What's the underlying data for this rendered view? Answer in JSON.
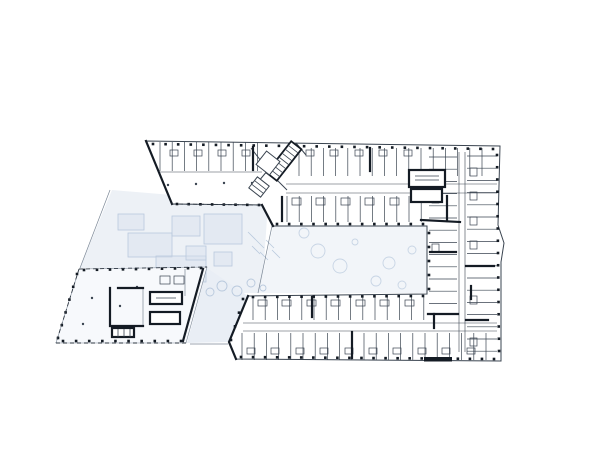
{
  "meta": {
    "drawing_type": "architectural-floor-plan",
    "canvas": {
      "width": 600,
      "height": 450
    }
  },
  "palette": {
    "white": "#ffffff",
    "ink": "#3a4450",
    "ink2": "#141b24",
    "thin": "#7c8897",
    "dash": "#2e3742",
    "wash": "#edf1f6",
    "wash2": "#e9eef5",
    "washCourt": "#f2f5f9",
    "pav": "#f7f9fc",
    "blue": "#b9c9dd",
    "blue2": "#d8e1ee"
  },
  "plan": {
    "washes": [
      {
        "name": "garden-wash",
        "points": "112,190 268,203 262,293 233,293 207,268 80,268",
        "fill": "wash"
      },
      {
        "name": "courtyard-wash",
        "points": "273,226 427,226 427,293 259,293",
        "fill": "washCourt"
      },
      {
        "name": "walkway-wash",
        "points": "207,268 248,296 229,342 187,343",
        "fill": "wash2"
      }
    ],
    "garden_rects": [
      [
        128,
        233,
        44,
        24
      ],
      [
        156,
        256,
        50,
        26
      ],
      [
        204,
        214,
        38,
        30
      ],
      [
        172,
        216,
        28,
        20
      ],
      [
        214,
        252,
        18,
        14
      ],
      [
        118,
        214,
        26,
        16
      ],
      [
        186,
        246,
        20,
        14
      ]
    ],
    "hatches": [
      [
        248,
        232,
        256,
        240
      ],
      [
        256,
        240,
        264,
        248
      ],
      [
        252,
        246,
        260,
        254
      ],
      [
        260,
        252,
        268,
        260
      ],
      [
        266,
        240,
        274,
        248
      ],
      [
        272,
        250,
        280,
        258
      ]
    ],
    "scribbles": [
      [
        222,
        286,
        5
      ],
      [
        237,
        291,
        5
      ],
      [
        251,
        283,
        4
      ],
      [
        263,
        288,
        3
      ],
      [
        210,
        292,
        4
      ]
    ],
    "trees": [
      [
        318,
        251,
        7
      ],
      [
        340,
        266,
        7
      ],
      [
        389,
        263,
        6
      ],
      [
        376,
        281,
        5
      ],
      [
        304,
        233,
        5
      ],
      [
        412,
        250,
        4
      ],
      [
        402,
        285,
        4
      ],
      [
        355,
        242,
        3
      ]
    ],
    "outline": "146,141 500,146 498,225 504,243 501,262 501,361 236,359 229,342 248,296 427,294 427,226 273,226 262,205 172,204",
    "pavilion": "79,269 207,267 186,343 56,343",
    "combs": [
      {
        "dir": "v",
        "o": 160,
        "s": 12.2,
        "n": 9,
        "a": 142,
        "b": 171
      },
      {
        "dir": "v",
        "o": 299,
        "s": 12.2,
        "n": 16,
        "a": 148,
        "b": 176
      },
      {
        "dir": "v",
        "o": 287,
        "s": 12.2,
        "n": 12,
        "a": 196,
        "b": 222
      },
      {
        "dir": "v",
        "o": 253,
        "s": 12.2,
        "n": 15,
        "a": 297,
        "b": 320
      },
      {
        "dir": "v",
        "o": 242,
        "s": 12.2,
        "n": 21,
        "a": 333,
        "b": 360
      },
      {
        "dir": "h",
        "o": 157,
        "s": 12.2,
        "n": 13,
        "a": 429,
        "b": 457
      },
      {
        "dir": "h",
        "o": 156,
        "s": 12.2,
        "n": 17,
        "a": 467,
        "b": 497
      }
    ],
    "corridors": [
      [
        286,
        184,
        497,
        184
      ],
      [
        286,
        193,
        497,
        193
      ],
      [
        243,
        323,
        497,
        323
      ],
      [
        243,
        331,
        497,
        331
      ],
      [
        459,
        152,
        459,
        352
      ],
      [
        465,
        152,
        465,
        352
      ],
      [
        160,
        172,
        262,
        172
      ]
    ],
    "thin_lines": [
      [
        143,
        288,
        143,
        326
      ],
      [
        185,
        269,
        185,
        296
      ],
      [
        272,
        226,
        258,
        293
      ],
      [
        190,
        344,
        228,
        344
      ],
      [
        110,
        190,
        80,
        268
      ]
    ],
    "diag_lines": [
      [
        251,
        148,
        268,
        170
      ],
      [
        268,
        170,
        258,
        182
      ],
      [
        296,
        143,
        306,
        155
      ],
      [
        277,
        180,
        287,
        190
      ]
    ],
    "pods": [
      [
        170,
        150,
        8,
        6
      ],
      [
        194,
        150,
        8,
        6
      ],
      [
        218,
        150,
        8,
        6
      ],
      [
        242,
        150,
        8,
        6
      ],
      [
        306,
        150,
        8,
        6
      ],
      [
        330,
        150,
        8,
        6
      ],
      [
        355,
        150,
        8,
        6
      ],
      [
        379,
        150,
        8,
        6
      ],
      [
        404,
        150,
        8,
        6
      ],
      [
        292,
        198,
        9,
        7
      ],
      [
        316,
        198,
        9,
        7
      ],
      [
        341,
        198,
        9,
        7
      ],
      [
        365,
        198,
        9,
        7
      ],
      [
        390,
        198,
        9,
        7
      ],
      [
        258,
        300,
        9,
        6
      ],
      [
        282,
        300,
        9,
        6
      ],
      [
        307,
        300,
        9,
        6
      ],
      [
        331,
        300,
        9,
        6
      ],
      [
        356,
        300,
        9,
        6
      ],
      [
        380,
        300,
        9,
        6
      ],
      [
        405,
        300,
        9,
        6
      ],
      [
        247,
        348,
        8,
        6
      ],
      [
        271,
        348,
        8,
        6
      ],
      [
        296,
        348,
        8,
        6
      ],
      [
        320,
        348,
        8,
        6
      ],
      [
        345,
        348,
        8,
        6
      ],
      [
        369,
        348,
        8,
        6
      ],
      [
        393,
        348,
        8,
        6
      ],
      [
        418,
        348,
        8,
        6
      ],
      [
        442,
        348,
        8,
        6
      ],
      [
        467,
        348,
        8,
        6
      ],
      [
        470,
        168,
        7,
        8
      ],
      [
        470,
        192,
        7,
        8
      ],
      [
        470,
        217,
        7,
        8
      ],
      [
        470,
        241,
        7,
        8
      ],
      [
        470,
        296,
        7,
        8
      ],
      [
        470,
        338,
        7,
        8
      ],
      [
        432,
        170,
        7,
        8
      ],
      [
        432,
        195,
        7,
        8
      ],
      [
        432,
        244,
        7,
        8
      ],
      [
        160,
        276,
        10,
        8
      ],
      [
        174,
        276,
        10,
        8
      ]
    ],
    "column_runs": [
      {
        "x1": 153,
        "y1": 144,
        "x2": 493,
        "y2": 149,
        "n": 28
      },
      {
        "x1": 177,
        "y1": 204,
        "x2": 259,
        "y2": 205,
        "n": 8
      },
      {
        "x1": 277,
        "y1": 224,
        "x2": 423,
        "y2": 224,
        "n": 13
      },
      {
        "x1": 253,
        "y1": 297,
        "x2": 423,
        "y2": 296,
        "n": 15
      },
      {
        "x1": 241,
        "y1": 357,
        "x2": 494,
        "y2": 359,
        "n": 22
      },
      {
        "x1": 497,
        "y1": 155,
        "x2": 499,
        "y2": 351,
        "n": 17
      },
      {
        "x1": 429,
        "y1": 233,
        "x2": 429,
        "y2": 289,
        "n": 5
      },
      {
        "x1": 84,
        "y1": 270,
        "x2": 201,
        "y2": 268,
        "n": 10
      },
      {
        "x1": 77,
        "y1": 274,
        "x2": 58,
        "y2": 338,
        "n": 6
      },
      {
        "x1": 63,
        "y1": 341,
        "x2": 181,
        "y2": 341,
        "n": 10
      },
      {
        "x1": 243,
        "y1": 299,
        "x2": 231,
        "y2": 340,
        "n": 4
      }
    ],
    "dots": [
      [
        168,
        185
      ],
      [
        196,
        184
      ],
      [
        224,
        183
      ],
      [
        252,
        183
      ],
      [
        92,
        298
      ],
      [
        83,
        324
      ],
      [
        137,
        287
      ],
      [
        120,
        306
      ]
    ],
    "bold_segments": [
      "146,141 172,204",
      "203,269 183,341",
      "248,296 229,342 236,359",
      "262,205 273,226",
      "421,220 460,222",
      "370,148 370,171",
      "253,147 253,170",
      "447,196 447,221",
      "430,252 456,252",
      "466,266 494,266",
      "428,314 458,314",
      "434,314 434,328",
      "466,320 488,320",
      "312,297 312,317",
      "352,332 352,358",
      "282,197 282,221",
      "110,288 110,326 143,326",
      "118,288 143,288",
      "471,286 471,299"
    ],
    "bars": [
      [
        424,
        357,
        28,
        4.5
      ]
    ],
    "cores": [
      {
        "x": 409,
        "y": 170,
        "w": 36,
        "h": 17,
        "inner": [
          [
            415,
            176,
            439,
            176
          ],
          [
            415,
            180,
            439,
            180
          ]
        ]
      },
      {
        "x": 411,
        "y": 189,
        "w": 31,
        "h": 13,
        "inner": []
      },
      {
        "x": 150,
        "y": 292,
        "w": 32,
        "h": 12,
        "inner": [
          [
            156,
            298,
            176,
            298
          ]
        ]
      },
      {
        "x": 150,
        "y": 312,
        "w": 30,
        "h": 12,
        "inner": []
      },
      {
        "x": 112,
        "y": 328,
        "w": 22,
        "h": 9,
        "inner": [
          [
            118,
            329,
            118,
            337
          ],
          [
            124,
            329,
            124,
            337
          ],
          [
            130,
            329,
            130,
            337
          ]
        ]
      }
    ],
    "stairs": [
      {
        "name": "main-stair",
        "cx": 284,
        "cy": 161,
        "w": 13,
        "h": 40,
        "angle": 38,
        "rungs": 7,
        "bold": true
      },
      {
        "name": "stair-landing",
        "cx": 268,
        "cy": 163,
        "w": 17,
        "h": 17,
        "angle": 38,
        "rungs": 0,
        "bold": false
      },
      {
        "name": "angled-room",
        "cx": 259,
        "cy": 187,
        "w": 15,
        "h": 14,
        "angle": 38,
        "rungs": 2,
        "bold": false
      }
    ],
    "dashed_edges": [
      [
        172,
        204,
        262,
        205
      ],
      [
        79,
        269,
        207,
        267
      ],
      [
        79,
        269,
        56,
        343
      ],
      [
        56,
        343,
        186,
        343
      ]
    ]
  }
}
